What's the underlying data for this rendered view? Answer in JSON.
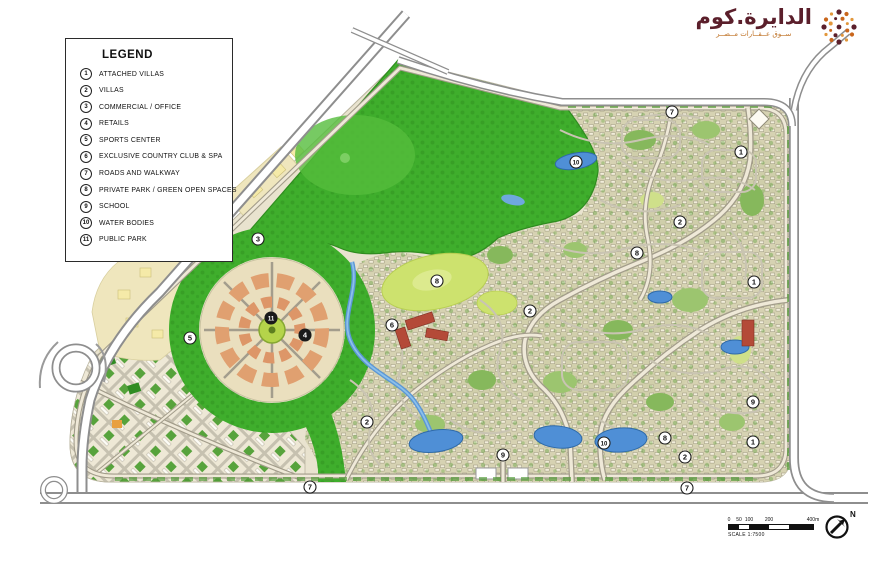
{
  "logo": {
    "title": "الدايرة.كوم",
    "tagline": "ســوق عــقــارات مــصــر",
    "icon": "dotted-circle-logo",
    "colors": {
      "maroon": "#5b1f2b",
      "orange": "#c9661c",
      "gold": "#e2973b"
    }
  },
  "legend": {
    "title": "LEGEND",
    "items": [
      {
        "num": "1",
        "label": "ATTACHED VILLAS"
      },
      {
        "num": "2",
        "label": "VILLAS"
      },
      {
        "num": "3",
        "label": "COMMERCIAL / OFFICE"
      },
      {
        "num": "4",
        "label": "RETAILS"
      },
      {
        "num": "5",
        "label": "SPORTS CENTER"
      },
      {
        "num": "6",
        "label": "EXCLUSIVE COUNTRY CLUB & SPA"
      },
      {
        "num": "7",
        "label": "ROADS AND WALKWAY"
      },
      {
        "num": "8",
        "label": "PRIVATE PARK / GREEN OPEN SPACES"
      },
      {
        "num": "9",
        "label": "SCHOOL"
      },
      {
        "num": "10",
        "label": "WATER BODIES"
      },
      {
        "num": "11",
        "label": "PUBLIC PARK"
      }
    ]
  },
  "map": {
    "colors": {
      "park_green": "#3fae2c",
      "golf_green": "#cde26e",
      "water_blue": "#4f8fd6",
      "base_beige": "#e9e3cf",
      "block_olive": "#d6d2b2",
      "club_red": "#b44a38"
    },
    "markers": [
      {
        "n": "7",
        "x": 672,
        "y": 112,
        "dark": false
      },
      {
        "n": "1",
        "x": 741,
        "y": 152,
        "dark": false
      },
      {
        "n": "10",
        "x": 576,
        "y": 162,
        "dark": false
      },
      {
        "n": "2",
        "x": 680,
        "y": 222,
        "dark": false
      },
      {
        "n": "3",
        "x": 258,
        "y": 239,
        "dark": false
      },
      {
        "n": "8",
        "x": 637,
        "y": 253,
        "dark": false
      },
      {
        "n": "8",
        "x": 437,
        "y": 281,
        "dark": false
      },
      {
        "n": "1",
        "x": 754,
        "y": 282,
        "dark": false
      },
      {
        "n": "2",
        "x": 530,
        "y": 311,
        "dark": false
      },
      {
        "n": "11",
        "x": 271,
        "y": 318,
        "dark": true
      },
      {
        "n": "6",
        "x": 392,
        "y": 325,
        "dark": false
      },
      {
        "n": "4",
        "x": 305,
        "y": 335,
        "dark": true
      },
      {
        "n": "5",
        "x": 190,
        "y": 338,
        "dark": false
      },
      {
        "n": "9",
        "x": 753,
        "y": 402,
        "dark": false
      },
      {
        "n": "2",
        "x": 367,
        "y": 422,
        "dark": false
      },
      {
        "n": "8",
        "x": 665,
        "y": 438,
        "dark": false
      },
      {
        "n": "10",
        "x": 604,
        "y": 443,
        "dark": false
      },
      {
        "n": "1",
        "x": 753,
        "y": 442,
        "dark": false
      },
      {
        "n": "2",
        "x": 685,
        "y": 457,
        "dark": false
      },
      {
        "n": "9",
        "x": 503,
        "y": 455,
        "dark": false
      },
      {
        "n": "7",
        "x": 687,
        "y": 488,
        "dark": false
      },
      {
        "n": "7",
        "x": 310,
        "y": 487,
        "dark": false
      }
    ]
  },
  "footer": {
    "scale": {
      "ticks": [
        "0",
        "50",
        "100",
        "200",
        "400m"
      ],
      "caption": "SCALE 1:7500"
    },
    "north_label": "N"
  }
}
